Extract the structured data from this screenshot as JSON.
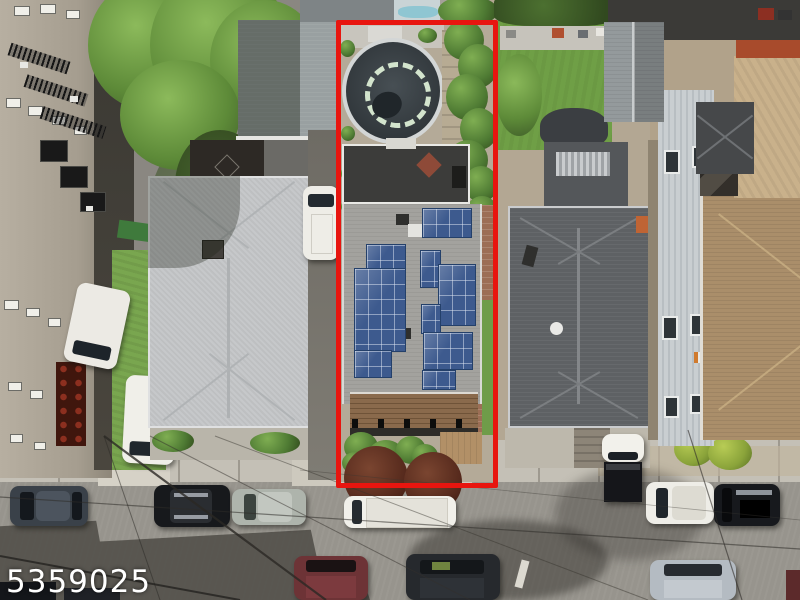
{
  "image_type": "aerial-drone-real-estate-photo",
  "watermark": {
    "text": "5359025",
    "color": "#ffffff"
  },
  "subject_property": {
    "boundary_color": "#e8150f",
    "boundary_stroke_px": 5,
    "features": [
      "above-ground pool with cover",
      "rear deck with white railing",
      "gray shingle roof with blue solar panel arrays",
      "front porch wood awning",
      "front garden shrubs",
      "side brick paver walk",
      "right-side green shrub hedge"
    ]
  },
  "surroundings": {
    "left": [
      "beige apartment building with fire escapes and windows",
      "large green tree",
      "light gray hip-roof house with chimney",
      "driveway with two white trucks",
      "stacked red buckets",
      "white van in driveway"
    ],
    "right": [
      "green backyard lawn with hedge",
      "dark gray hip-roof house with white round vent",
      "light gray sided building with windows",
      "brown shingle hip roof house",
      "tan dirt yard",
      "dark flat roofs",
      "gray gable roof",
      "dark pyramid garage roof"
    ],
    "bottom": [
      "asphalt street",
      "concrete sidewalks",
      "parked cars both sides",
      "white van",
      "white box truck",
      "power lines",
      "building shadows",
      "two dark-red leafed street trees",
      "round street marking"
    ]
  },
  "palette": {
    "boundary_red": "#e8150f",
    "solar_panel_blue": "#3d5a8e",
    "shingle_gray": "#a3a29e",
    "light_roof_gray": "#c6c8ca",
    "dark_roof_gray": "#5e6164",
    "brown_roof_tan": "#aa8e6a",
    "street_asphalt": "#97948d",
    "sidewalk_concrete": "#c4c0b6",
    "lawn_green": "#6f9f46",
    "tree_green": "#5d8a38",
    "red_leaf_tree": "#55291c",
    "pool_cover_charcoal": "#3a4247",
    "deck_wood_brown": "#8a6a4c",
    "apartment_beige": "#b2aa9c",
    "white_vehicle": "#f0efe9"
  }
}
